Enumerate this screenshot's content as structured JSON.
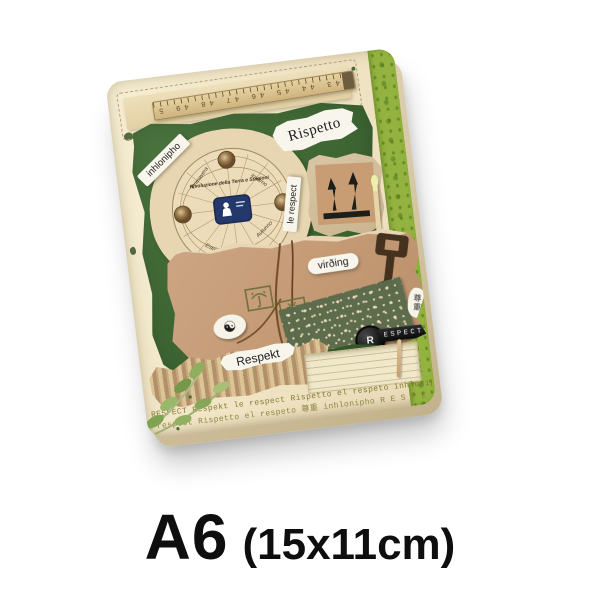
{
  "caption": {
    "size": "A6",
    "dimensions": "(15x11cm)"
  },
  "notebook": {
    "labels": {
      "rispetto": "Rispetto",
      "inhlonipho": "inhlonipho",
      "le_respect": "le respect",
      "virding": "virðing",
      "respekt": "Respekt",
      "typewriter_key": "R",
      "label_tape": "ESPECT",
      "chinese_respect": "尊重",
      "recycle_glyph": "☯"
    },
    "seasons_chart": {
      "title": "Rivoluzione della Terra e Stagioni",
      "seasons": [
        "Primavera",
        "Estate",
        "Autunno",
        "Inverno"
      ]
    },
    "ruler": {
      "numbers": "43 44 45 46 47 48 49 50"
    },
    "band": {
      "line1": "RESPECT Respekt le respect Rispetto el respeto inhlonipho R",
      "line2": "e respect Rispetto el respeto 尊重 inhlonipho R E S P E C T P."
    },
    "colors": {
      "cover_cream": "#f1e6c7",
      "collage_green": "#3f6834",
      "edge_lime": "#93b23f",
      "cardboard_tan": "#c59b76",
      "washi_green": "#5a6b4b",
      "badge_navy": "#24386b",
      "band_text": "#857a35",
      "caption_black": "#0e0e0e"
    }
  }
}
